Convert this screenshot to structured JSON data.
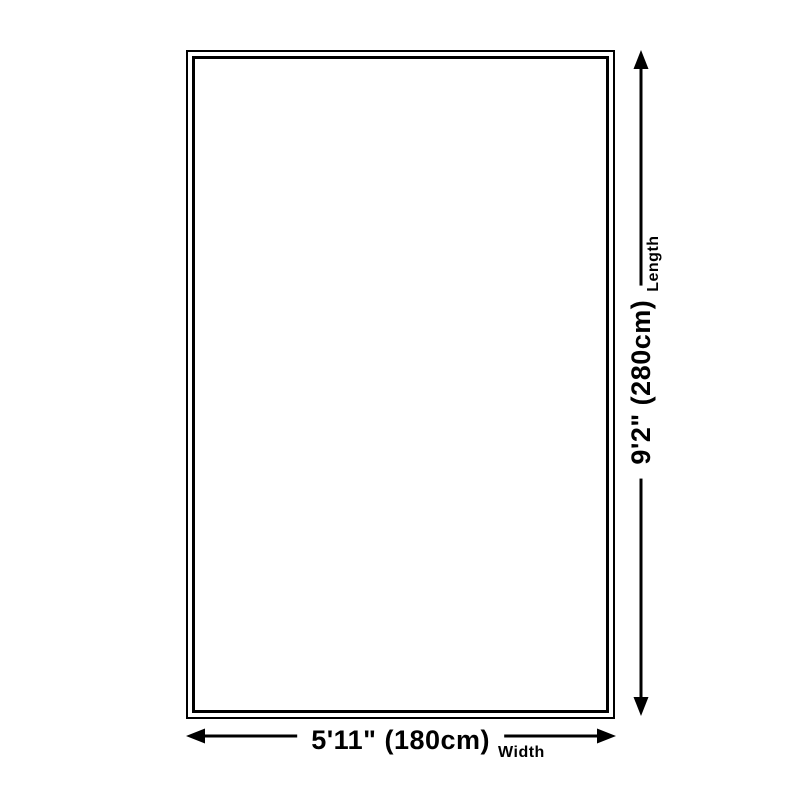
{
  "diagram": {
    "type": "product-dimension-diagram",
    "background_color": "#ffffff",
    "line_color": "#000000",
    "length": {
      "value": "9'2\" (280cm)",
      "label": "Length"
    },
    "width": {
      "value": "5'11\" (180cm)",
      "label": "Width"
    }
  }
}
